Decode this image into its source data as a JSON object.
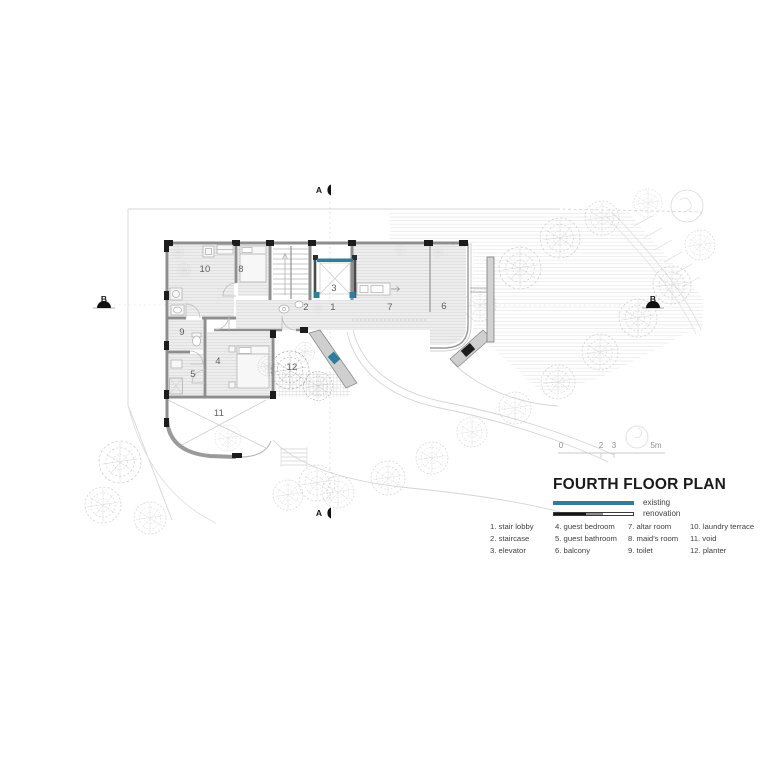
{
  "plan": {
    "room_labels": {
      "r1": "1",
      "r2": "2",
      "r3": "3",
      "r4": "4",
      "r5": "5",
      "r6": "6",
      "r7": "7",
      "r8": "8",
      "r9": "9",
      "r10": "10",
      "r11": "11",
      "r12": "12"
    },
    "section_markers": {
      "top": "A",
      "bottom": "A",
      "left": "B",
      "right": "B"
    }
  },
  "scale_bar": {
    "labels": [
      "0",
      "2",
      "3",
      "5m"
    ]
  },
  "title_block": {
    "title": "FOURTH FLOOR PLAN",
    "legend": {
      "existing": "existing",
      "renovation": "renovation"
    }
  },
  "room_list": {
    "columns": [
      {
        "items": [
          "1. stair lobby",
          "2. staircase",
          "3. elevator"
        ]
      },
      {
        "items": [
          "4. guest bedroom",
          "5. guest bathroom",
          "6. balcony"
        ]
      },
      {
        "items": [
          "7. altar room",
          "8. maid's room",
          "9. toilet"
        ]
      },
      {
        "items": [
          "10. laundry terrace",
          "11. void",
          "12. planter"
        ]
      }
    ]
  },
  "colors": {
    "existing_blue": "#2e7d9e",
    "renovation_dark": "#141414",
    "wall_gray": "#8e8e8e"
  }
}
